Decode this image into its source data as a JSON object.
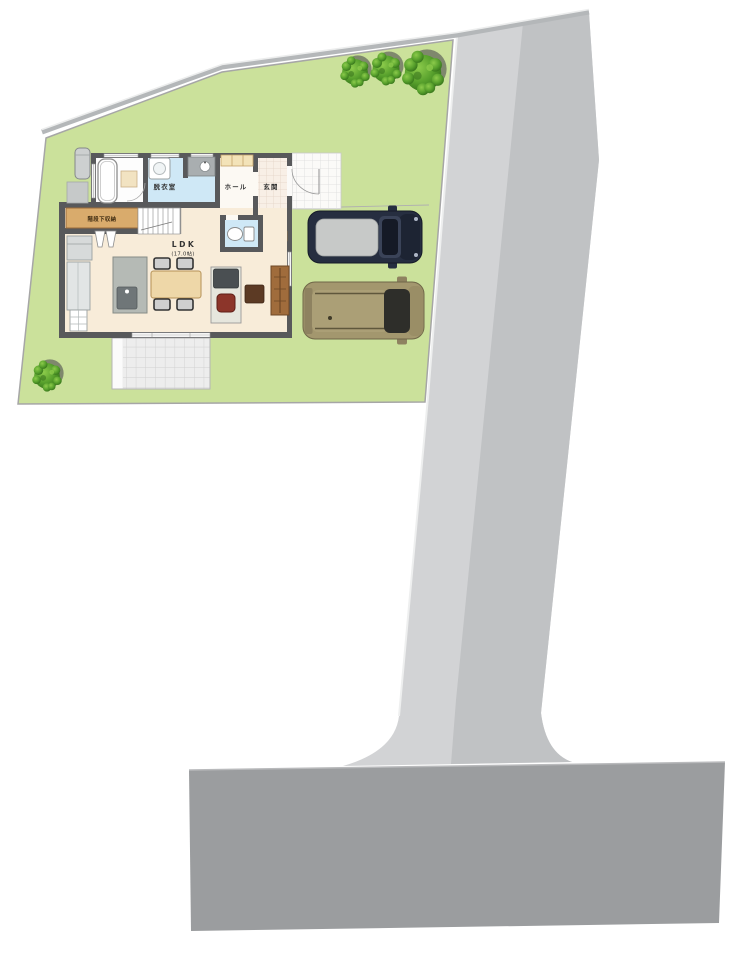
{
  "floor_plan": {
    "labels": {
      "dressing_room": "脱衣室",
      "hall": "ホール",
      "entrance": "玄関",
      "under_stairs_storage": "階段下収納",
      "ldk": "LDK",
      "ldk_area": "(17.0帖)"
    },
    "colors": {
      "lot_green": "#cbe19b",
      "road_light": "#d2d3d5",
      "road_dark": "#c0c2c4",
      "road_lower": "#9b9d9f",
      "curb_band": "#b4b7b9",
      "wall_gray": "#58595b",
      "ldk_floor": "#f8ecd9",
      "wet_area_blue": "#cfe8f6",
      "storage_tan": "#d9ab6c",
      "entry_step_tan": "#e6aa5e",
      "car_navy": "#262e40",
      "car_khaki": "#a3976e",
      "tree_green": "#569b2f"
    }
  }
}
